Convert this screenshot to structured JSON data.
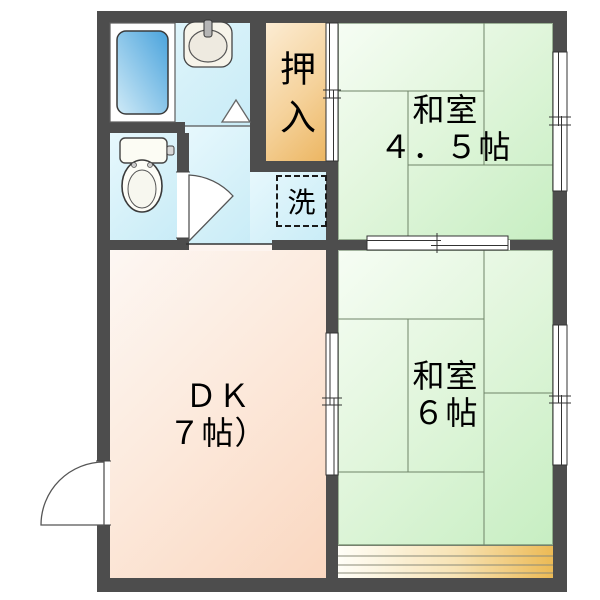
{
  "floorplan": {
    "type": "japanese-apartment-floor-plan",
    "rooms": {
      "washitsu45": {
        "name": "和室",
        "size": "４．５帖"
      },
      "washitsu6": {
        "name": "和室",
        "size": "６帖"
      },
      "dk": {
        "name": "ＤＫ",
        "size": "７帖）"
      },
      "oshiire": {
        "name": "押入"
      },
      "laundry": {
        "name": "洗"
      }
    },
    "fixtures": [
      "bathtub",
      "wash-basin",
      "toilet",
      "washing-machine-space"
    ],
    "colors": {
      "wall": "#4d4d4d",
      "tatami_light": "#f6fdf4",
      "tatami_dark": "#c7eec2",
      "dk_light": "#fdf7f3",
      "dk_dark": "#fad7c0",
      "oshiire_light": "#fcecd3",
      "oshiire_dark": "#ecb662",
      "water_area": "#d6f1f9",
      "engawa_accent": "#ecba55",
      "bathtub_blue": "#4aa3dc",
      "text": "#000000"
    }
  }
}
